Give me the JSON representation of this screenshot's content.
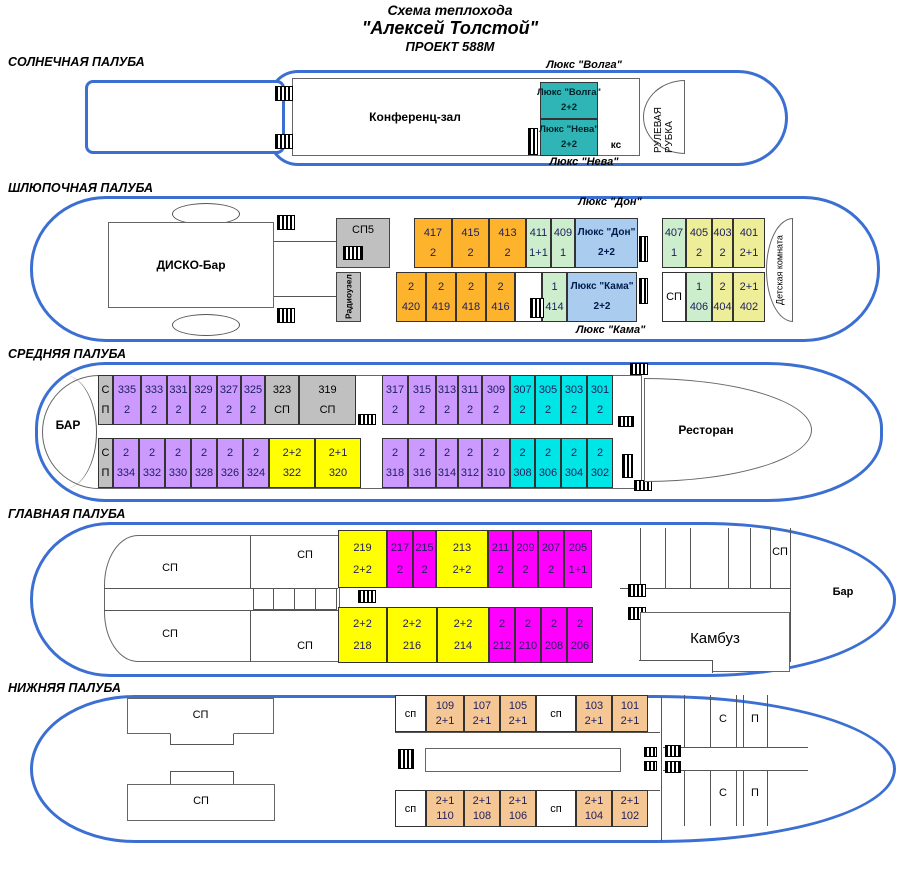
{
  "title": {
    "line1": "Схема теплохода",
    "line2": "\"Алексей Толстой\"",
    "line3": "ПРОЕКТ 588М"
  },
  "colors": {
    "hull_blue": "#3b6fd1",
    "cabin_orange": "#fdb42c",
    "cabin_pale_yellow": "#eeee99",
    "cabin_green": "#cceecc",
    "cabin_lux_blue": "#aaccee",
    "cabin_teal": "#2fb5b5",
    "cabin_purple": "#cc99ff",
    "cabin_cyan": "#00e6e6",
    "cabin_yellow": "#ffff00",
    "cabin_magenta": "#ff00ff",
    "cabin_peach": "#f5c795",
    "service_gray": "#c0c0c0"
  },
  "decks": {
    "sun": {
      "label": "СОЛНЕЧНАЯ ПАЛУБА",
      "conference": "Конференц-зал",
      "lux_volga_label": "Люкс \"Волга\"",
      "lux_neva_label": "Люкс \"Нева\"",
      "ks": "кс",
      "wheelhouse": "РУЛЕВАЯ РУБКА",
      "lux_cabins": [
        {
          "n": "Люкс \"Волга\"",
          "c": "2+2",
          "t": "teal"
        },
        {
          "n": "Люкс \"Нева\"",
          "c": "2+2",
          "t": "teal"
        }
      ]
    },
    "boat": {
      "label": "ШЛЮПОЧНАЯ ПАЛУБА",
      "disco": "ДИСКО-Бар",
      "sp5": "СП5",
      "radio": "Радиоузел",
      "lux_don_label": "Люкс \"Дон\"",
      "lux_kama_label": "Люкс \"Кама\"",
      "kids_room": "Детская комната",
      "row_top": [
        {
          "n": "417",
          "c": "2",
          "t": "orange"
        },
        {
          "n": "415",
          "c": "2",
          "t": "orange"
        },
        {
          "n": "413",
          "c": "2",
          "t": "orange"
        },
        {
          "n": "411",
          "c": "1+1",
          "t": "green"
        },
        {
          "n": "409",
          "c": "1",
          "t": "green"
        },
        {
          "n": "Люкс \"Дон\"",
          "c": "2+2",
          "t": "lux"
        }
      ],
      "row_bottom": [
        {
          "n": "2",
          "c": "420",
          "t": "orange"
        },
        {
          "n": "2",
          "c": "419",
          "t": "orange"
        },
        {
          "n": "2",
          "c": "418",
          "t": "orange"
        },
        {
          "n": "2",
          "c": "416",
          "t": "orange"
        },
        {
          "t": "white"
        },
        {
          "n": "1",
          "c": "414",
          "t": "green"
        },
        {
          "n": "Люкс \"Кама\"",
          "c": "2+2",
          "t": "lux"
        }
      ],
      "right_top": [
        {
          "n": "407",
          "c": "1",
          "t": "green"
        },
        {
          "n": "405",
          "c": "2",
          "t": "paleyellow"
        },
        {
          "n": "403",
          "c": "2",
          "t": "paleyellow"
        },
        {
          "n": "401",
          "c": "2+1",
          "t": "paleyellow"
        }
      ],
      "right_bottom": [
        {
          "n": "СП",
          "t": "white"
        },
        {
          "n": "1",
          "c": "406",
          "t": "green"
        },
        {
          "n": "2",
          "c": "404",
          "t": "paleyellow"
        },
        {
          "n": "2+1",
          "c": "402",
          "t": "paleyellow"
        }
      ]
    },
    "middle": {
      "label": "СРЕДНЯЯ ПАЛУБА",
      "bar": "БАР",
      "restaurant": "Ресторан",
      "row_top_left": [
        {
          "n": "С",
          "c": "П",
          "t": "gray"
        },
        {
          "n": "335",
          "c": "2",
          "t": "purple"
        },
        {
          "n": "333",
          "c": "2",
          "t": "purple"
        },
        {
          "n": "331",
          "c": "2",
          "t": "purple"
        },
        {
          "n": "329",
          "c": "2",
          "t": "purple"
        },
        {
          "n": "327",
          "c": "2",
          "t": "purple"
        },
        {
          "n": "325",
          "c": "2",
          "t": "purple"
        },
        {
          "n": "323",
          "c": "СП",
          "t": "gray"
        },
        {
          "n": "319",
          "c": "СП",
          "t": "gray"
        }
      ],
      "row_top_right": [
        {
          "n": "317",
          "c": "2",
          "t": "purple"
        },
        {
          "n": "315",
          "c": "2",
          "t": "purple"
        },
        {
          "n": "313",
          "c": "2",
          "t": "purple"
        },
        {
          "n": "311",
          "c": "2",
          "t": "purple"
        },
        {
          "n": "309",
          "c": "2",
          "t": "purple"
        },
        {
          "n": "307",
          "c": "2",
          "t": "cyan"
        },
        {
          "n": "305",
          "c": "2",
          "t": "cyan"
        },
        {
          "n": "303",
          "c": "2",
          "t": "cyan"
        },
        {
          "n": "301",
          "c": "2",
          "t": "cyan"
        }
      ],
      "row_bottom_left": [
        {
          "n": "С",
          "c": "П",
          "t": "gray"
        },
        {
          "n": "2",
          "c": "334",
          "t": "purple"
        },
        {
          "n": "2",
          "c": "332",
          "t": "purple"
        },
        {
          "n": "2",
          "c": "330",
          "t": "purple"
        },
        {
          "n": "2",
          "c": "328",
          "t": "purple"
        },
        {
          "n": "2",
          "c": "326",
          "t": "purple"
        },
        {
          "n": "2",
          "c": "324",
          "t": "purple"
        },
        {
          "n": "2+2",
          "c": "322",
          "t": "yellow"
        },
        {
          "n": "2+1",
          "c": "320",
          "t": "yellow"
        }
      ],
      "row_bottom_right": [
        {
          "n": "2",
          "c": "318",
          "t": "purple"
        },
        {
          "n": "2",
          "c": "316",
          "t": "purple"
        },
        {
          "n": "2",
          "c": "314",
          "t": "purple"
        },
        {
          "n": "2",
          "c": "312",
          "t": "purple"
        },
        {
          "n": "2",
          "c": "310",
          "t": "purple"
        },
        {
          "n": "2",
          "c": "308",
          "t": "cyan"
        },
        {
          "n": "2",
          "c": "306",
          "t": "cyan"
        },
        {
          "n": "2",
          "c": "304",
          "t": "cyan"
        },
        {
          "n": "2",
          "c": "302",
          "t": "cyan"
        }
      ]
    },
    "main": {
      "label": "ГЛАВНАЯ ПАЛУБА",
      "sp_tl": "СП",
      "sp_tr": "СП",
      "sp_bl": "СП",
      "sp_br": "СП",
      "sp_right": "СП",
      "galley": "Камбуз",
      "bar": "Бар",
      "row_top": [
        {
          "n": "219",
          "c": "2+2",
          "t": "yellow"
        },
        {
          "n": "217",
          "c": "2",
          "t": "magenta"
        },
        {
          "n": "215",
          "c": "2",
          "t": "magenta"
        },
        {
          "n": "213",
          "c": "2+2",
          "t": "yellow"
        },
        {
          "n": "211",
          "c": "2",
          "t": "magenta"
        },
        {
          "n": "209",
          "c": "2",
          "t": "magenta"
        },
        {
          "n": "207",
          "c": "2",
          "t": "magenta"
        },
        {
          "n": "205",
          "c": "1+1",
          "t": "magenta"
        }
      ],
      "row_bottom": [
        {
          "n": "2+2",
          "c": "218",
          "t": "yellow"
        },
        {
          "n": "2+2",
          "c": "216",
          "t": "yellow"
        },
        {
          "n": "2+2",
          "c": "214",
          "t": "yellow"
        },
        {
          "n": "2",
          "c": "212",
          "t": "magenta"
        },
        {
          "n": "2",
          "c": "210",
          "t": "magenta"
        },
        {
          "n": "2",
          "c": "208",
          "t": "magenta"
        },
        {
          "n": "2",
          "c": "206",
          "t": "magenta"
        }
      ]
    },
    "lower": {
      "label": "НИЖНЯЯ ПАЛУБА",
      "sp_top": "СП",
      "sp_bottom": "СП",
      "s_letter": "С",
      "p_letter": "П",
      "row_top": [
        {
          "n": "сп",
          "t": "white"
        },
        {
          "n": "109",
          "c": "2+1",
          "t": "peach"
        },
        {
          "n": "107",
          "c": "2+1",
          "t": "peach"
        },
        {
          "n": "105",
          "c": "2+1",
          "t": "peach"
        },
        {
          "n": "сп",
          "t": "white"
        },
        {
          "n": "103",
          "c": "2+1",
          "t": "peach"
        },
        {
          "n": "101",
          "c": "2+1",
          "t": "peach"
        }
      ],
      "row_bottom": [
        {
          "n": "сп",
          "t": "white"
        },
        {
          "n": "2+1",
          "c": "110",
          "t": "peach"
        },
        {
          "n": "2+1",
          "c": "108",
          "t": "peach"
        },
        {
          "n": "2+1",
          "c": "106",
          "t": "peach"
        },
        {
          "n": "сп",
          "t": "white"
        },
        {
          "n": "2+1",
          "c": "104",
          "t": "peach"
        },
        {
          "n": "2+1",
          "c": "102",
          "t": "peach"
        }
      ]
    }
  }
}
